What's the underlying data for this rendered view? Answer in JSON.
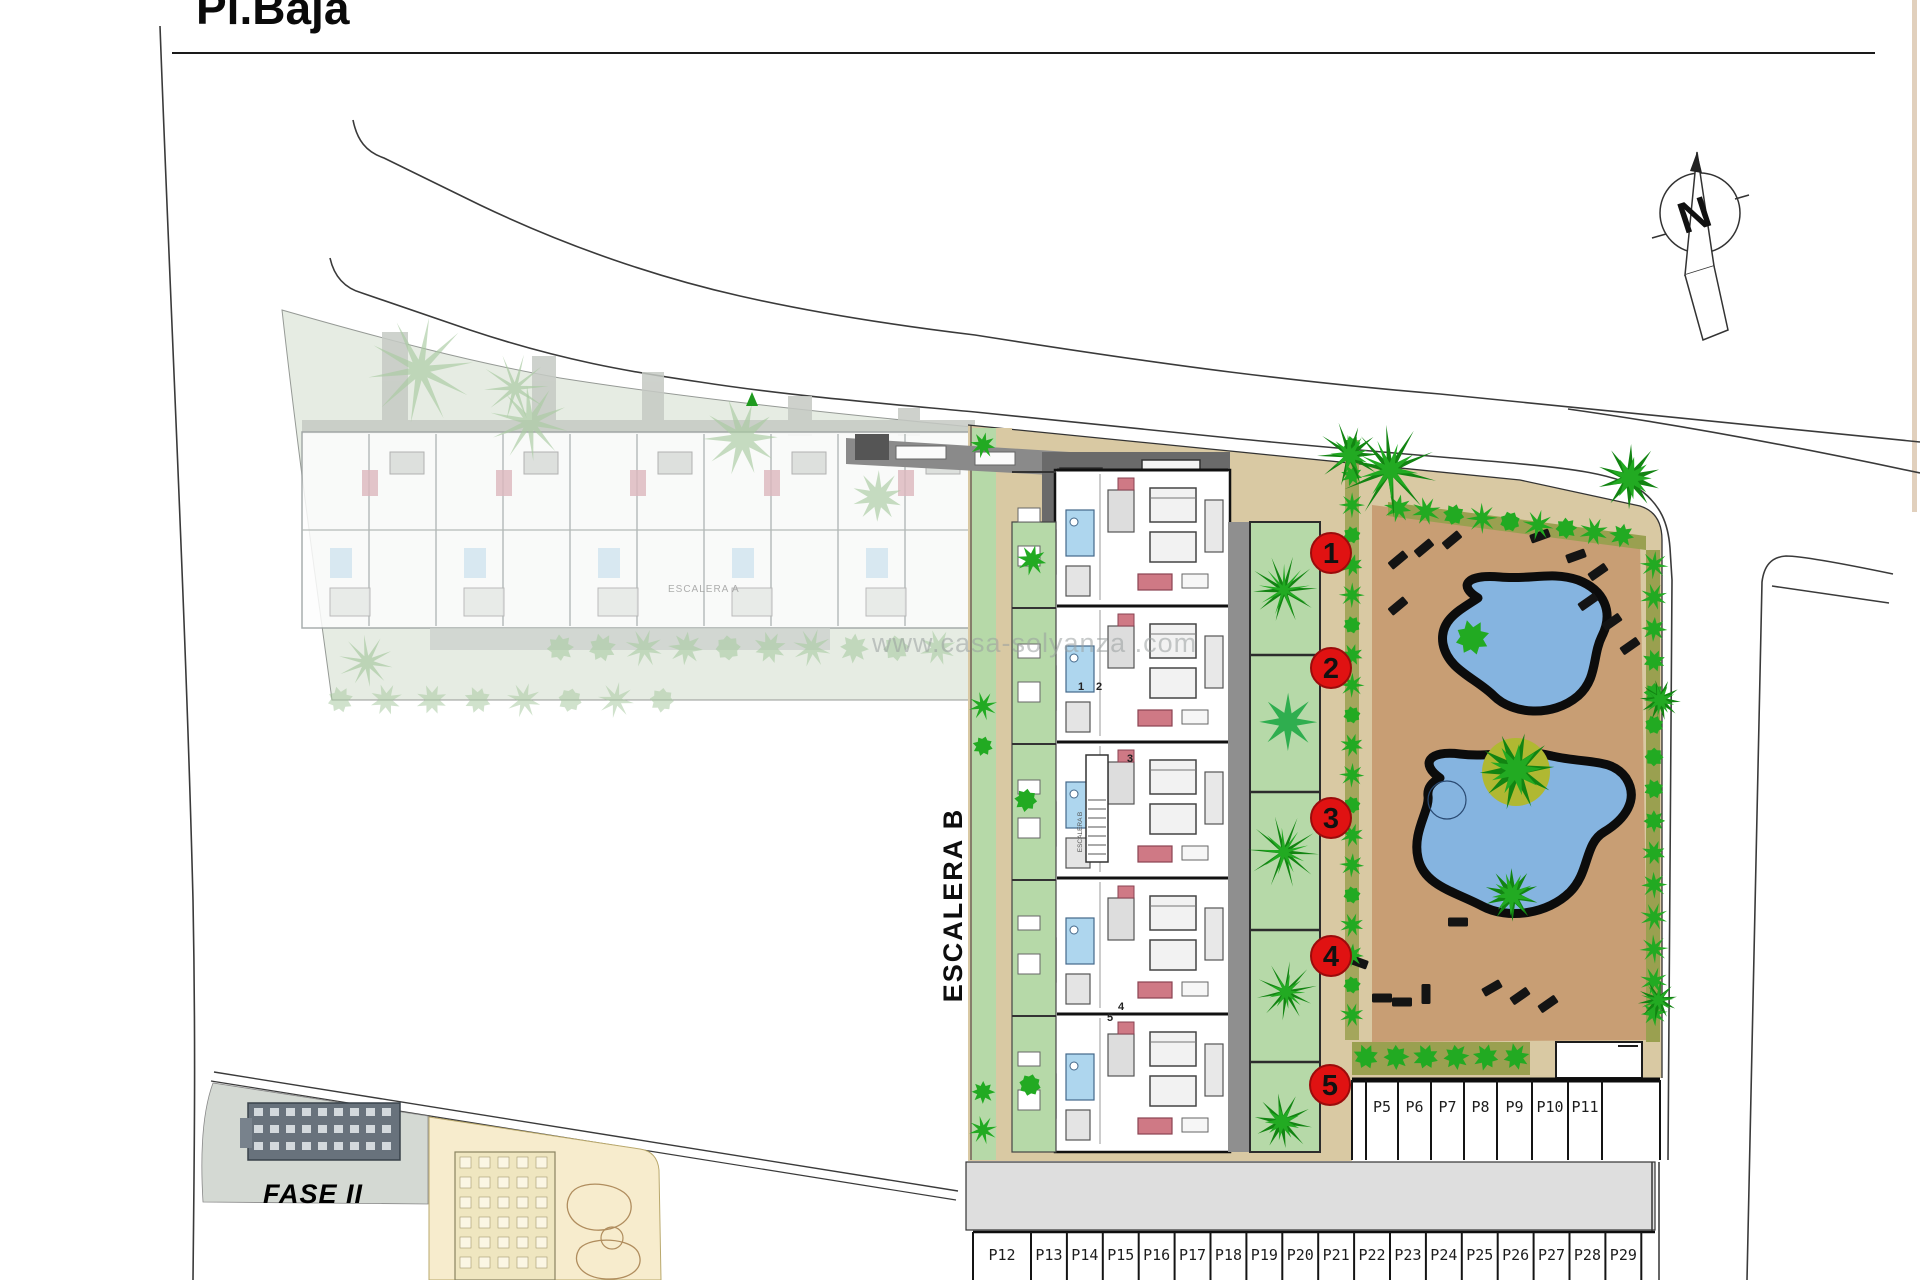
{
  "title": "Pl.Baja",
  "watermark": {
    "text": "www.casa-solyanza .com"
  },
  "north": {
    "label": "N"
  },
  "labels": {
    "escalera_b": "ESCALERA B",
    "escalera_b_inner": "ESCALERA B",
    "escalera_a": "ESCALERA A",
    "fase": "FASE II"
  },
  "markers": {
    "items": [
      "1",
      "2",
      "3",
      "4",
      "5"
    ]
  },
  "plan_numbers": [
    "1",
    "2",
    "3",
    "4",
    "5"
  ],
  "parking": {
    "row_upper": [
      "P5",
      "P6",
      "P7",
      "P8",
      "P9",
      "P10",
      "P11"
    ],
    "row_lower": [
      "P12",
      "P13",
      "P14",
      "P15",
      "P16",
      "P17",
      "P18",
      "P19",
      "P20",
      "P21",
      "P22",
      "P23",
      "P24",
      "P25",
      "P26",
      "P27",
      "P28",
      "P29"
    ]
  },
  "colors": {
    "marker_red": "#e01212",
    "fase_red": "#e01111",
    "courtyard_tan": "#d9c9a3",
    "pool_tan": "#c89e74",
    "pool_blue": "#85b4e0",
    "garden_green": "#b6d9a8",
    "bush_green": "#22aa22",
    "bush_dark": "#128412",
    "hedge_olive": "#9aa050",
    "faded_green": "#a9cba2",
    "road_gray": "#dedede",
    "line_dark": "#3a3a3a"
  }
}
